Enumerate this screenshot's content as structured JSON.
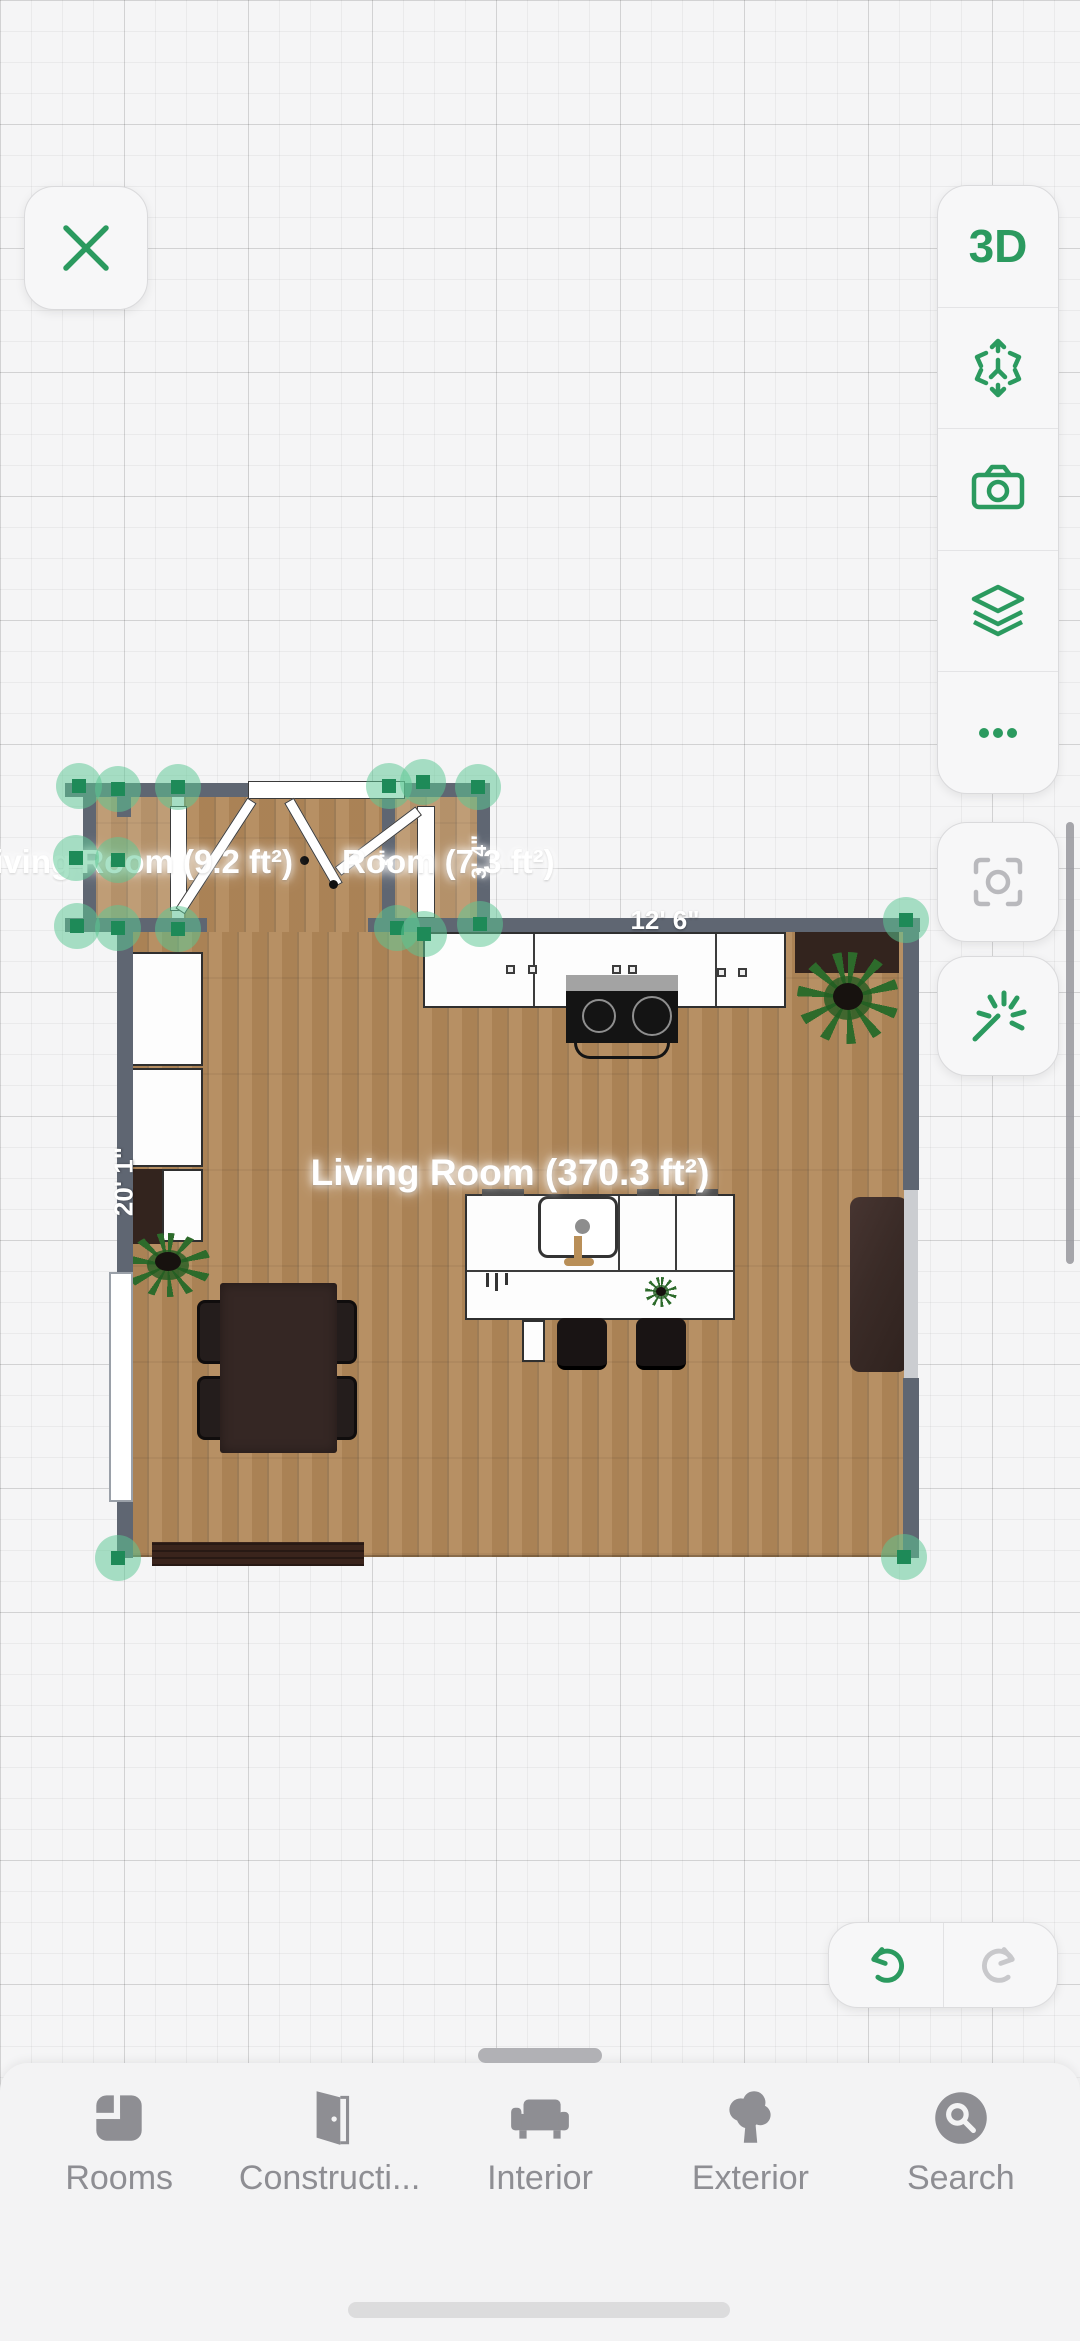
{
  "close_button": {
    "icon": "close-icon"
  },
  "toolbar": {
    "items": [
      {
        "label": "3D"
      },
      {
        "icon": "ar-move-icon"
      },
      {
        "icon": "camera-icon"
      },
      {
        "icon": "layers-icon"
      },
      {
        "icon": "more-ellipsis-icon"
      }
    ]
  },
  "side_buttons": {
    "items": [
      {
        "icon": "screenshot-focus-icon"
      },
      {
        "icon": "magic-wand-icon"
      }
    ]
  },
  "floorplan": {
    "labels": {
      "living_room_main": "Living Room (370.3 ft²)",
      "living_room_small": "Living Room (9.2 ft²)",
      "room_small": "Room (7.3 ft²)"
    },
    "dimensions": {
      "top_wall": "12' 6\"",
      "left_wall": "20' 1\"",
      "right_room_side": "3' 4\"",
      "right_room_inner": "3\""
    }
  },
  "history": {
    "undo": {
      "icon": "undo-icon",
      "enabled": true
    },
    "redo": {
      "icon": "redo-icon",
      "enabled": false
    }
  },
  "bottom_nav": {
    "items": [
      {
        "label": "Rooms",
        "icon": "rooms-icon"
      },
      {
        "label": "Constructi...",
        "icon": "construction-door-icon"
      },
      {
        "label": "Interior",
        "icon": "interior-sofa-icon"
      },
      {
        "label": "Exterior",
        "icon": "exterior-tree-icon"
      },
      {
        "label": "Search",
        "icon": "search-icon"
      }
    ]
  },
  "colors": {
    "accent_green": "#2b9a5f",
    "handle_green": "#5cc894",
    "wall_gray": "#5f6672",
    "wood_floor": "#b3895a",
    "nav_gray": "#8e8e93",
    "canvas_bg": "#f5f5f6"
  }
}
